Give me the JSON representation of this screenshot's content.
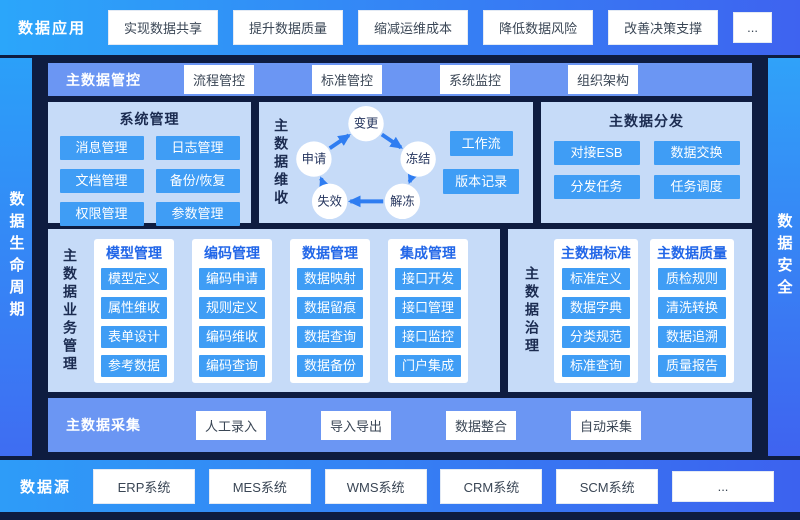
{
  "top_bar": {
    "label": "数据应用",
    "items": [
      "实现数据共享",
      "提升数据质量",
      "缩减运维成本",
      "降低数据风险",
      "改善决策支撑",
      "..."
    ]
  },
  "left_bar": {
    "label": "数据生命周期"
  },
  "right_bar": {
    "label": "数据安全"
  },
  "control_row": {
    "label": "主数据管控",
    "items": [
      "流程管控",
      "标准管控",
      "系统监控",
      "组织架构"
    ]
  },
  "system_panel": {
    "title": "系统管理",
    "items": [
      "消息管理",
      "日志管理",
      "文档管理",
      "备份/恢复",
      "权限管理",
      "参数管理"
    ]
  },
  "maintenance_panel": {
    "title": "主数据维收",
    "cycle": [
      "变更",
      "冻结",
      "解冻",
      "失效",
      "申请"
    ],
    "side_items": [
      "工作流",
      "版本记录"
    ]
  },
  "distribution_panel": {
    "title": "主数据分发",
    "items": [
      "对接ESB",
      "数据交换",
      "分发任务",
      "任务调度"
    ]
  },
  "business_panel": {
    "title": "主数据业务管理",
    "columns": [
      {
        "title": "模型管理",
        "items": [
          "模型定义",
          "属性维收",
          "表单设计",
          "参考数据"
        ]
      },
      {
        "title": "编码管理",
        "items": [
          "编码申请",
          "规则定义",
          "编码维收",
          "编码查询"
        ]
      },
      {
        "title": "数据管理",
        "items": [
          "数据映射",
          "数据留痕",
          "数据查询",
          "数据备份"
        ]
      },
      {
        "title": "集成管理",
        "items": [
          "接口开发",
          "接口管理",
          "接口监控",
          "门户集成"
        ]
      }
    ]
  },
  "governance_panel": {
    "title": "主数据治理",
    "columns": [
      {
        "title": "主数据标准",
        "items": [
          "标准定义",
          "数据字典",
          "分类规范",
          "标准查询"
        ]
      },
      {
        "title": "主数据质量",
        "items": [
          "质检规则",
          "清洗转换",
          "数据追溯",
          "质量报告"
        ]
      }
    ]
  },
  "collection_row": {
    "label": "主数据采集",
    "items": [
      "人工录入",
      "导入导出",
      "数据整合",
      "自动采集"
    ]
  },
  "source_bar": {
    "label": "数据源",
    "items": [
      "ERP系统",
      "MES系统",
      "WMS系统",
      "CRM系统",
      "SCM系统",
      "..."
    ]
  },
  "colors": {
    "frame_gradient_start": "#2BA6FA",
    "frame_gradient_end": "#3E63F0",
    "dark_background": "#0E1C40",
    "row_blue": "#6B96F3",
    "panel_light_blue": "#C6DBF8",
    "button_azure": "#3F9DF5",
    "column_title_blue": "#2166E8",
    "dark_text": "#1B2B50",
    "arrow_blue": "#2F7DF1"
  }
}
